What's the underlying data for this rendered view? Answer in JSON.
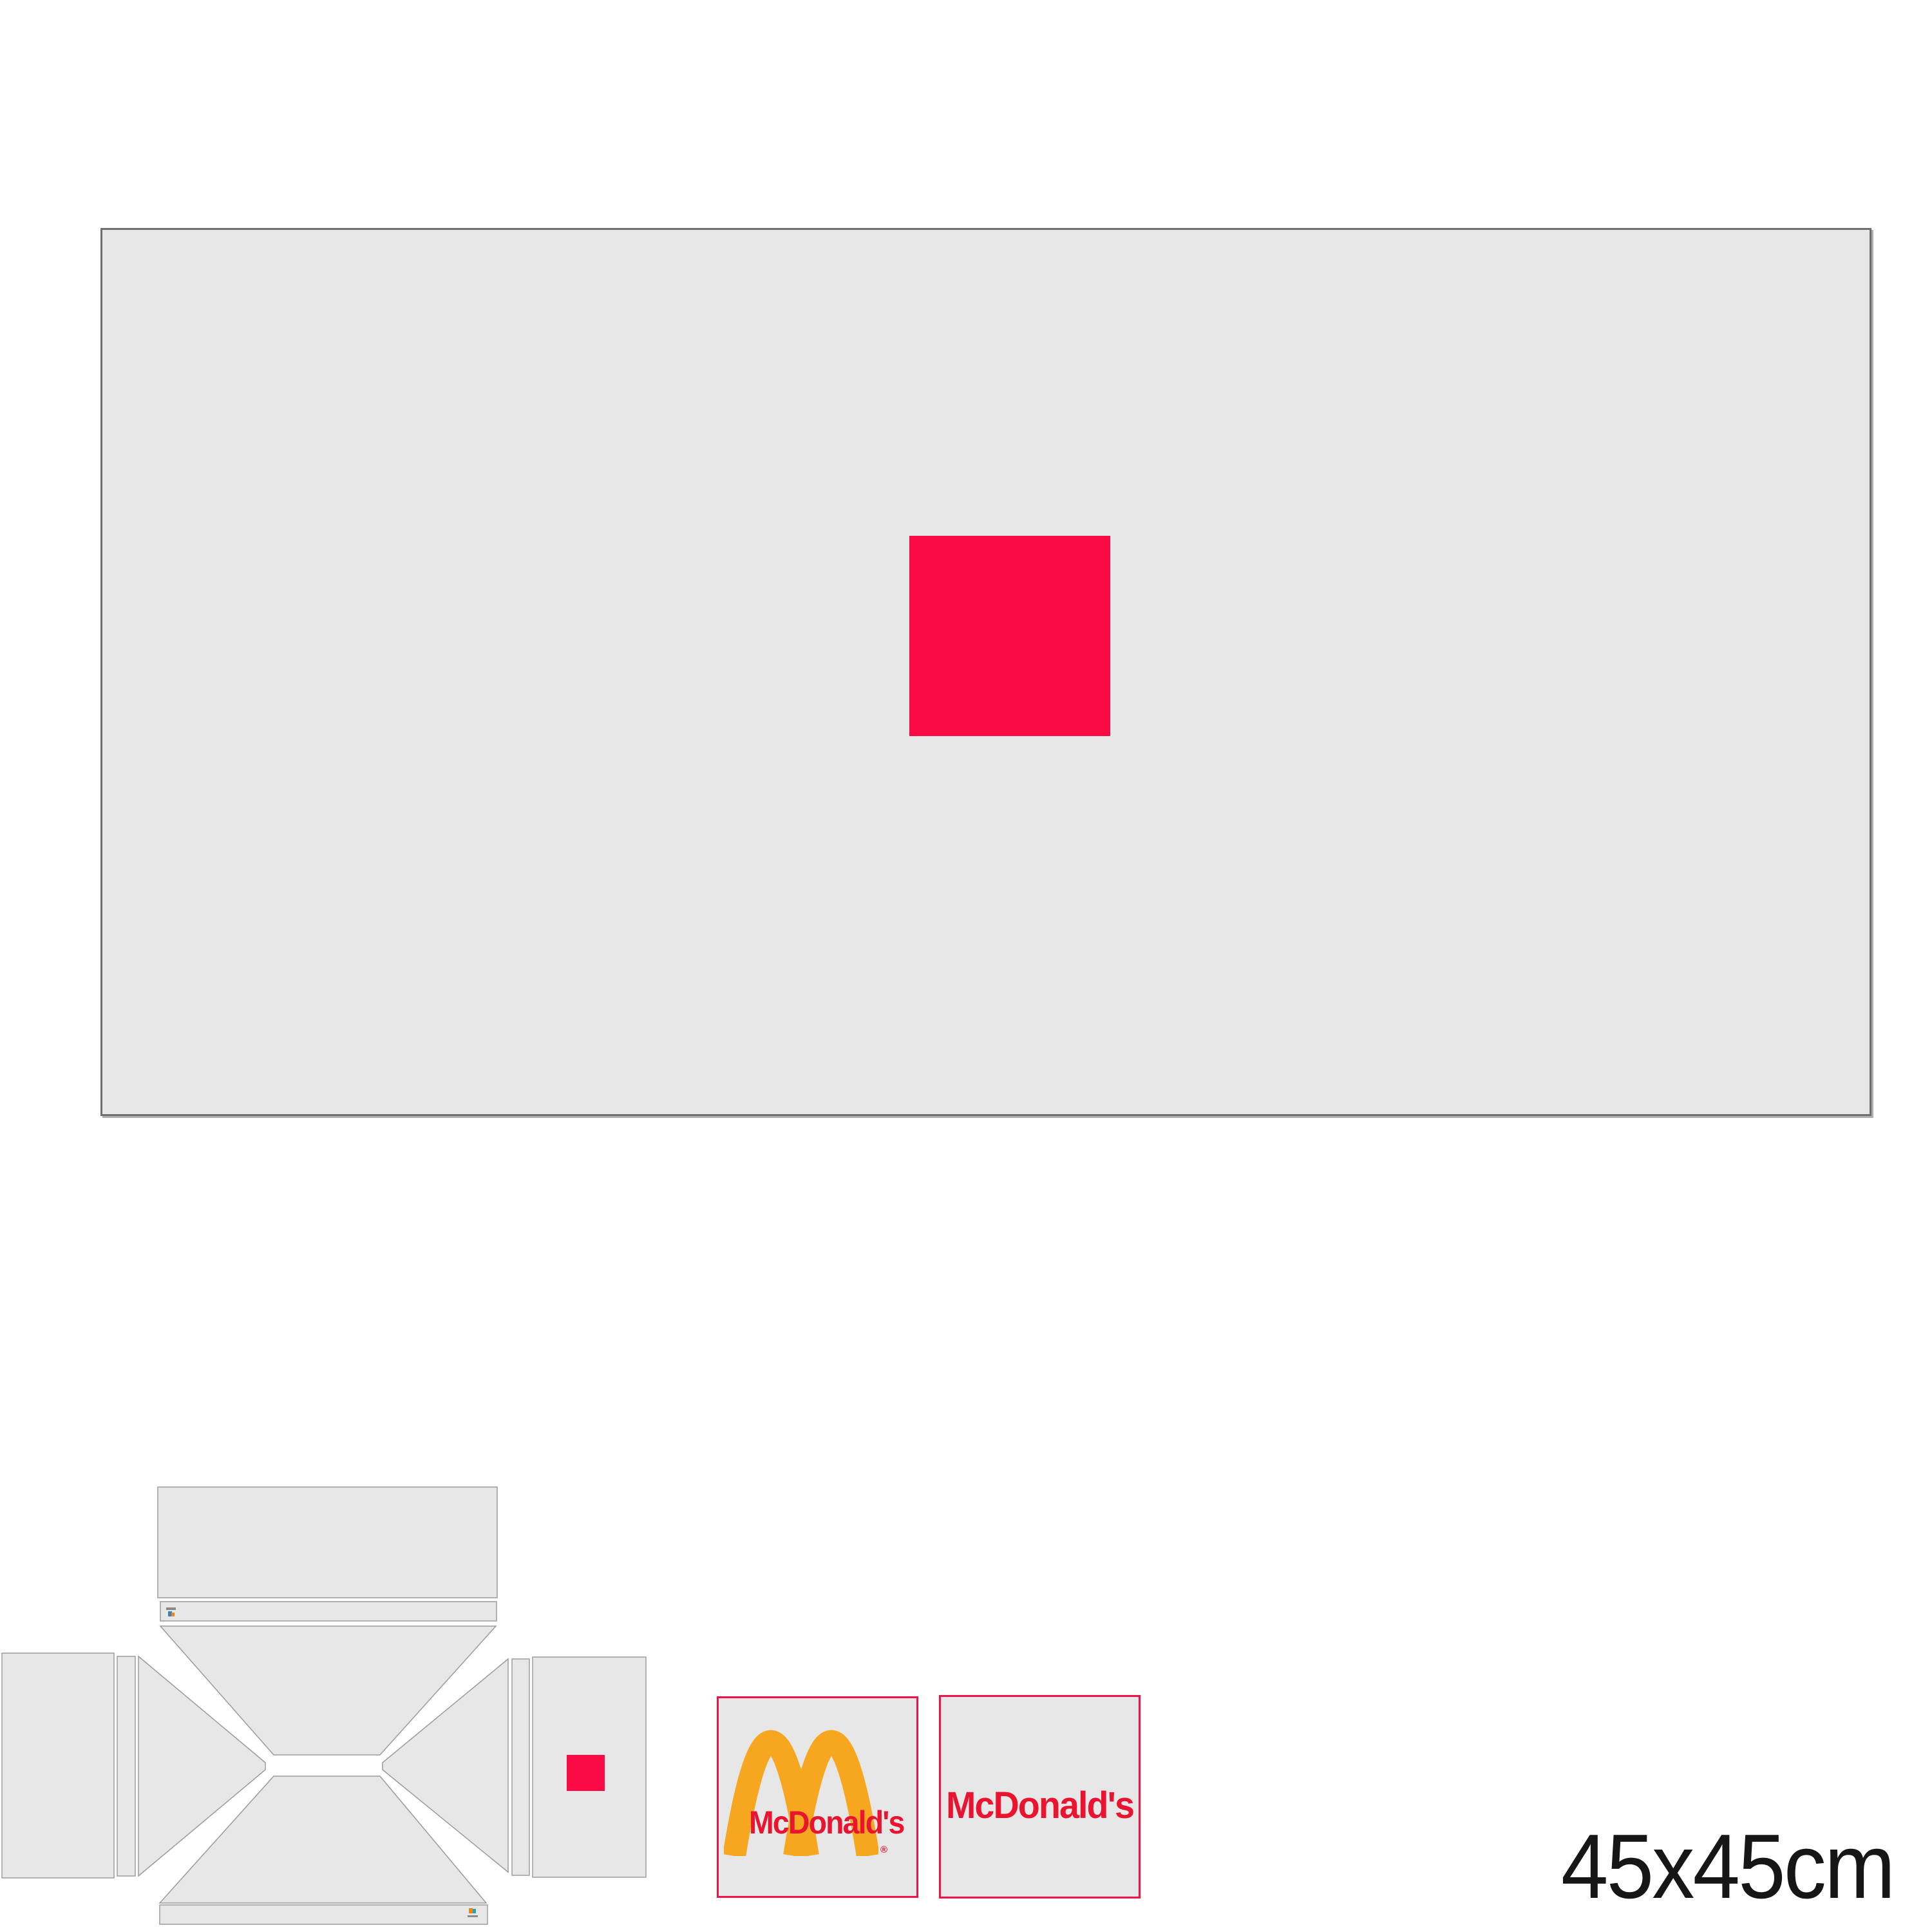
{
  "colors": {
    "page_bg": "#ffffff",
    "panel_fill": "#e7e7e7",
    "panel_border": "#6e6e6e",
    "panel_shadow": "#b0b0b0",
    "dieline_fill": "#e7e7e7",
    "dieline_stroke": "#9b9b9b",
    "accent_pink": "#fb0b45",
    "swatch_border": "#ee1448",
    "brand_red": "#e91530",
    "brand_gold": "#f6a71f",
    "label_text": "#161616",
    "mark_orange": "#e8871f",
    "mark_blue": "#3f7fbe",
    "mark_teal": "#2fa3a0",
    "mark_gray": "#8a8a8a"
  },
  "icons": {
    "arches": "golden-arches-icon",
    "printer_mark_top": "printer-mark",
    "printer_mark_bottom": "printer-mark"
  },
  "swatches": {
    "logo": {
      "wordmark": "McDonald's",
      "registered_mark": "®"
    },
    "wordmark": {
      "text": "McDonald's"
    }
  },
  "size_label": "45x45cm"
}
